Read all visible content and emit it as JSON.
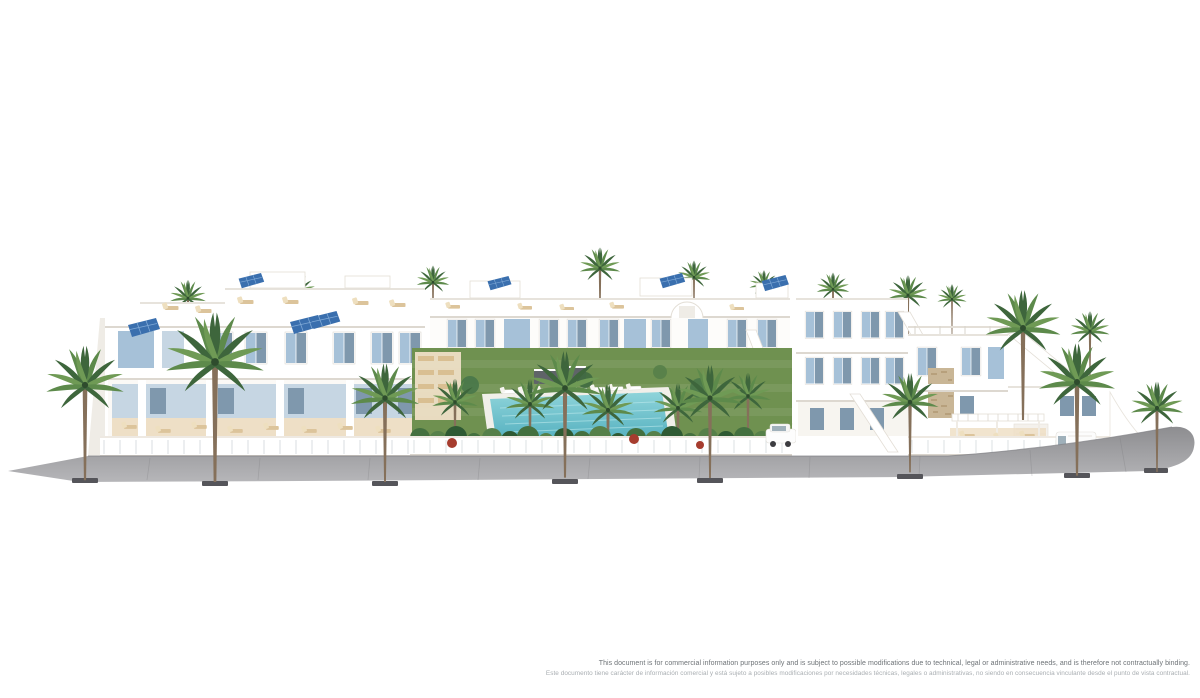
{
  "image": {
    "kind": "3d-architectural-render",
    "subject": "Front view render of a white Mediterranean residential complex: terraced apartments and villas with roof terraces, sun loungers, solar panels, light-blue shutters, a central landscaped courtyard with communal swimming pool and lawn, and a palm-lined grey sidewalk promenade on a plain white background",
    "background": "#ffffff",
    "features": [
      "white apartment blocks",
      "roof terraces with sun loungers",
      "solar panels",
      "light blue window shutters",
      "communal swimming pool",
      "green lawn courtyard",
      "tropical plants and palm trees",
      "grey sidewalk with palm trees",
      "white perimeter wall with glass balustrade",
      "stepped villas with external staircases",
      "pergola terrace",
      "white parked vehicles"
    ]
  },
  "palette": {
    "background": "#ffffff",
    "building_shade": "#efece6",
    "building_shade_deep": "#ddd8d0",
    "shutter_blue": "#a6c1d8",
    "ground_wall_blue": "#c6d6e3",
    "window_glass": "#7f98ad",
    "solar_panel": "#3a6fae",
    "lawn_green": "#6f9150",
    "lounger_tan": "#dcc49b",
    "terrace_floor": "#eedfc6",
    "trunk_brown": "#85705a",
    "palm_dark": "#3e663c",
    "palm_mid": "#5d8a4b",
    "palm_light": "#6f9a55",
    "pool_turquoise": "#7fcad2",
    "sidewalk_gray": "#9b9b9e",
    "flower_red": "#a63c2e",
    "stone_tan": "#c9b696"
  },
  "disclaimer": {
    "line1": "This document is for commercial information purposes only and is subject to possible modifications due to technical, legal or administrative needs, and is therefore not contractually binding.",
    "line2": "Este documento tiene carácter de información comercial y está sujeto a posibles modificaciones por necesidades técnicas, legales o administrativas, no siendo en consecuencia vinculante desde el punto de vista contractual."
  }
}
